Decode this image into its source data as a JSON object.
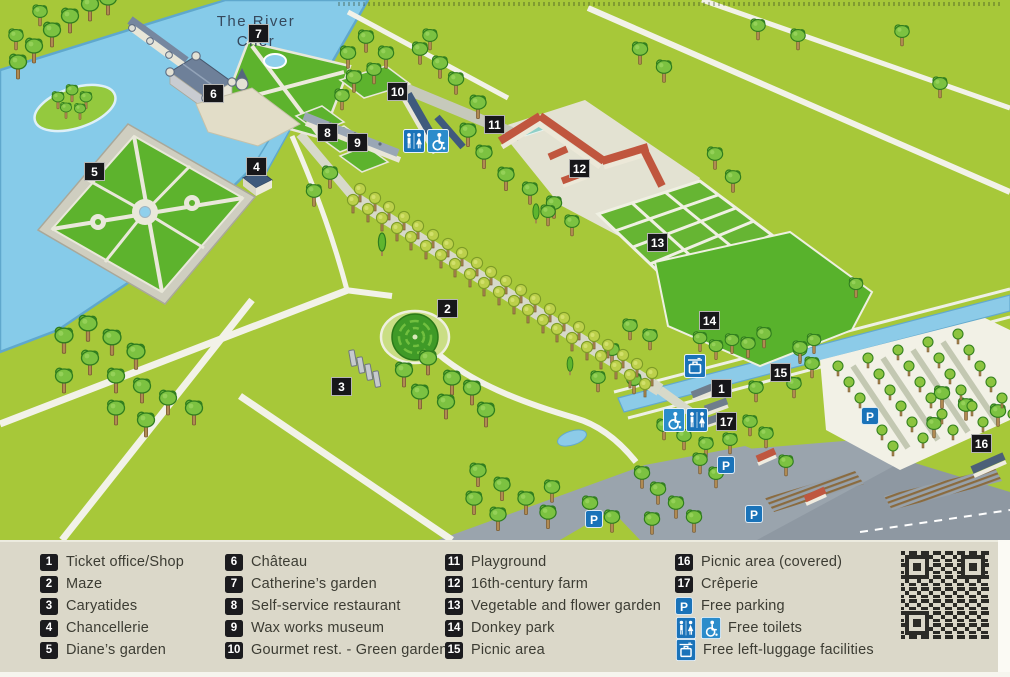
{
  "map": {
    "river_line1": "The River",
    "river_line2": "Cher",
    "markers": [
      {
        "n": "1"
      },
      {
        "n": "2"
      },
      {
        "n": "3"
      },
      {
        "n": "4"
      },
      {
        "n": "5"
      },
      {
        "n": "6"
      },
      {
        "n": "7"
      },
      {
        "n": "8"
      },
      {
        "n": "9"
      },
      {
        "n": "10"
      },
      {
        "n": "11"
      },
      {
        "n": "12"
      },
      {
        "n": "13"
      },
      {
        "n": "14"
      },
      {
        "n": "15"
      },
      {
        "n": "16"
      },
      {
        "n": "17"
      }
    ]
  },
  "legend": {
    "c1": [
      {
        "n": "1",
        "t": "Ticket office/Shop"
      },
      {
        "n": "2",
        "t": "Maze"
      },
      {
        "n": "3",
        "t": "Caryatides"
      },
      {
        "n": "4",
        "t": "Chancellerie"
      },
      {
        "n": "5",
        "t": "Diane’s garden"
      }
    ],
    "c2": [
      {
        "n": "6",
        "t": "Château"
      },
      {
        "n": "7",
        "t": "Catherine’s garden"
      },
      {
        "n": "8",
        "t": "Self-service restaurant"
      },
      {
        "n": "9",
        "t": "Wax works museum"
      },
      {
        "n": "10",
        "t": "Gourmet rest. - Green garden"
      }
    ],
    "c3": [
      {
        "n": "11",
        "t": "Playground"
      },
      {
        "n": "12",
        "t": "16th-century farm"
      },
      {
        "n": "13",
        "t": "Vegetable and flower garden"
      },
      {
        "n": "14",
        "t": "Donkey park"
      },
      {
        "n": "15",
        "t": "Picnic area"
      }
    ],
    "c4": [
      {
        "n": "16",
        "t": "Picnic area (covered)"
      },
      {
        "n": "17",
        "t": "Crêperie"
      }
    ],
    "p_letter": "P",
    "parking_label": "Free parking",
    "toilets_label": "Free toilets",
    "luggage_label": "Free left-luggage facilities"
  },
  "colors": {
    "grass": "#a7c839",
    "garden_green": "#5db32d",
    "water": "#86cbe9",
    "marker_black": "#17171a",
    "icon_blue": "#1a73b9",
    "farm_roof_red": "#c0563e",
    "legend_bg": "#dbd8c9"
  }
}
